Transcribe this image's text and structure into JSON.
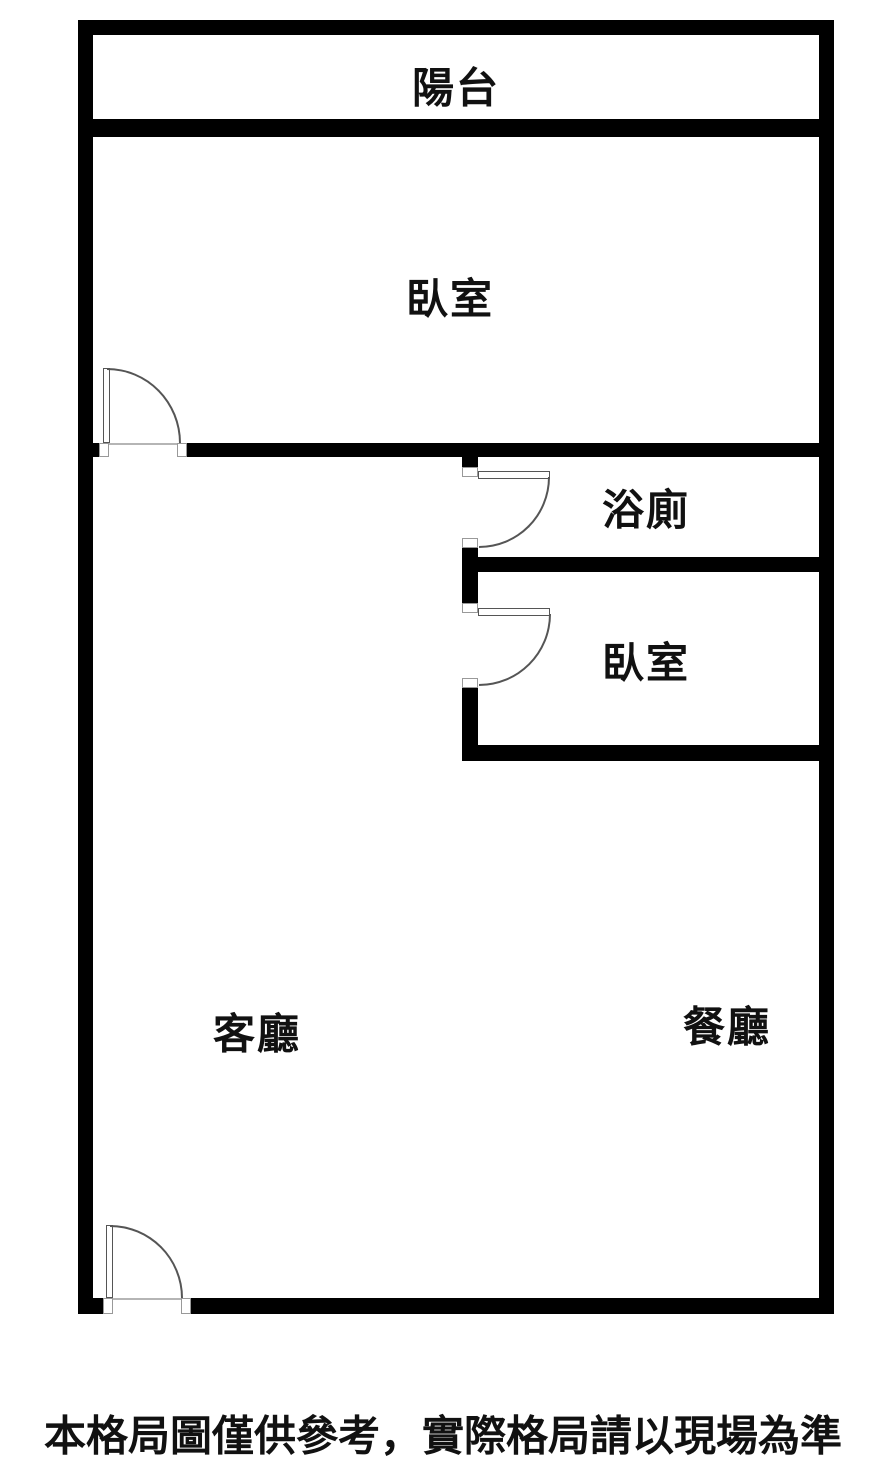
{
  "colors": {
    "background": "#ffffff",
    "wall": "#000000",
    "door_line": "#555555",
    "jamb_border": "#999999",
    "text": "#111111"
  },
  "rooms": {
    "balcony": {
      "label": "陽台"
    },
    "bedroom_top": {
      "label": "臥室"
    },
    "bathroom": {
      "label": "浴廁"
    },
    "bedroom_right": {
      "label": "臥室"
    },
    "living": {
      "label": "客廳"
    },
    "dining": {
      "label": "餐廳"
    }
  },
  "caption": {
    "text": "本格局圖僅供參考，實際格局請以現場為準"
  }
}
